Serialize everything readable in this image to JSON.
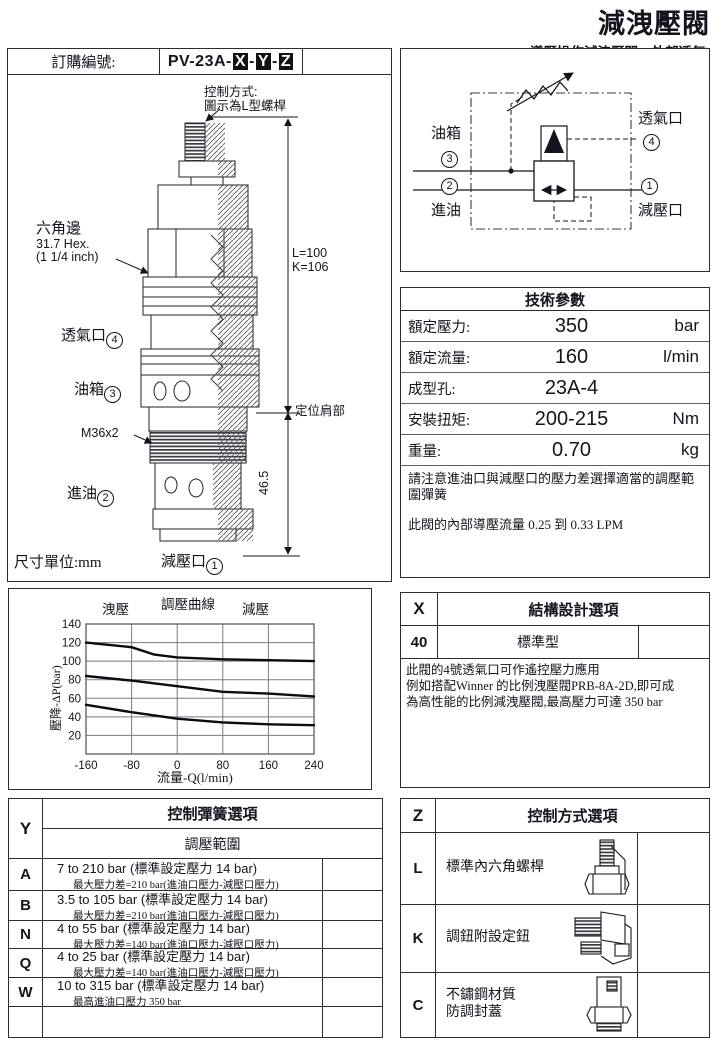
{
  "page": {
    "title": "減洩壓閥",
    "subtitle": "(導壓操作減洩壓閥、外部透氣)"
  },
  "colors": {
    "ink": "#14141e",
    "line": "#2b2b33"
  },
  "order": {
    "label": "訂購編號:",
    "code_prefix": "PV-23A-",
    "code_x": "X",
    "code_y": "Y",
    "code_z": "Z",
    "dash": "-"
  },
  "drawing": {
    "control_note_line1": "控制方式:",
    "control_note_line2": "圖示為L型螺桿",
    "hex_line1": "六角邊",
    "hex_line2": "31.7 Hex.",
    "hex_line3": "(1 1/4 inch)",
    "vent_port": "透氣口",
    "vent_num": "4",
    "tank_port": "油箱",
    "tank_num": "3",
    "thread_label": "M36x2",
    "inlet_port": "進油",
    "inlet_num": "2",
    "reduce_port": "減壓口",
    "reduce_num": "1",
    "dim_l": "L=100",
    "dim_k": "K=106",
    "shoulder_label": "定位肩部",
    "dim_shoulder": "46.5",
    "unit_note": "尺寸單位:mm"
  },
  "symbol": {
    "tank_label": "油箱",
    "tank_num": "3",
    "inlet_num": "2",
    "inlet_label": "進油",
    "vent_label": "透氣口",
    "vent_num": "4",
    "reduce_num": "1",
    "reduce_label": "減壓口"
  },
  "tech": {
    "header": "技術參數",
    "rows": [
      {
        "label": "額定壓力:",
        "value": "350",
        "unit": "bar"
      },
      {
        "label": "額定流量:",
        "value": "160",
        "unit": "l/min"
      },
      {
        "label": "成型孔:",
        "value": "23A-4",
        "unit": ""
      },
      {
        "label": "安裝扭矩:",
        "value": "200-215",
        "unit": "Nm"
      },
      {
        "label": "重量:",
        "value": "0.70",
        "unit": "kg"
      }
    ],
    "note1": "請注意進油口與減壓口的壓力差選擇適當的調壓範圍彈簧",
    "note2": "此閥的內部導壓流量 0.25 到 0.33 LPM"
  },
  "chart_data": {
    "type": "line",
    "title": "調壓曲線",
    "label_left": "洩壓",
    "label_right": "減壓",
    "xlabel": "流量-Q(l/min)",
    "ylabel": "壓降-ΔP(bar)",
    "xlim": [
      -160,
      240
    ],
    "ylim": [
      0,
      140
    ],
    "xticks": [
      -160,
      -80,
      0,
      80,
      160,
      240
    ],
    "yticks": [
      20,
      40,
      60,
      80,
      100,
      120,
      140
    ],
    "grid": true,
    "legend_position": "none",
    "series": [
      {
        "name": "high-pressure-spring",
        "x": [
          -160,
          -80,
          -40,
          0,
          80,
          160,
          240
        ],
        "y": [
          120,
          115,
          107,
          104,
          102,
          101,
          100
        ]
      },
      {
        "name": "mid-pressure-spring",
        "x": [
          -160,
          -80,
          0,
          80,
          160,
          240
        ],
        "y": [
          84,
          79,
          73,
          67,
          65,
          62
        ]
      },
      {
        "name": "low-pressure-spring",
        "x": [
          -160,
          -80,
          0,
          80,
          160,
          240
        ],
        "y": [
          53,
          45,
          38,
          34,
          32,
          31
        ]
      }
    ]
  },
  "x_options": {
    "letter": "X",
    "header": "結構設計選項",
    "row_code": "40",
    "row_label": "標準型",
    "note_line1": "此閥的4號透氣口可作遙控壓力應用",
    "note_line2": "例如搭配Winner 的比例洩壓閥PRB-8A-2D,即可成",
    "note_line3": "為高性能的比例減洩壓閥,最高壓力可達 350 bar"
  },
  "y_options": {
    "letter": "Y",
    "header": "控制彈簧選項",
    "subheader": "調壓範圍",
    "rows": [
      {
        "code": "A",
        "main": "7 to 210 bar  (標準設定壓力 14 bar)",
        "sub": "最大壓力差=210 bar(進油口壓力-減壓口壓力)"
      },
      {
        "code": "B",
        "main": "3.5 to 105 bar  (標準設定壓力 14 bar)",
        "sub": "最大壓力差=210 bar(進油口壓力-減壓口壓力)"
      },
      {
        "code": "N",
        "main": "4 to 55 bar   (標準設定壓力 14 bar)",
        "sub": "最大壓力差=140 bar(進油口壓力-減壓口壓力)"
      },
      {
        "code": "Q",
        "main": "4 to 25 bar   (標準設定壓力 14 bar)",
        "sub": "最大壓力差=140 bar(進油口壓力-減壓口壓力)"
      },
      {
        "code": "W",
        "main": "10 to 315 bar  (標準設定壓力 14 bar)",
        "sub": "最高進油口壓力 350 bar"
      }
    ]
  },
  "z_options": {
    "letter": "Z",
    "header": "控制方式選項",
    "rows": [
      {
        "code": "L",
        "label": "標準內六角螺桿",
        "label2": "",
        "icon": "hex-screw-icon"
      },
      {
        "code": "K",
        "label": "調鈕附設定鈕",
        "label2": "",
        "icon": "adjust-knob-icon"
      },
      {
        "code": "C",
        "label": "不鏽鋼材質",
        "label2": "防調封蓋",
        "icon": "tamper-cap-icon"
      }
    ]
  }
}
